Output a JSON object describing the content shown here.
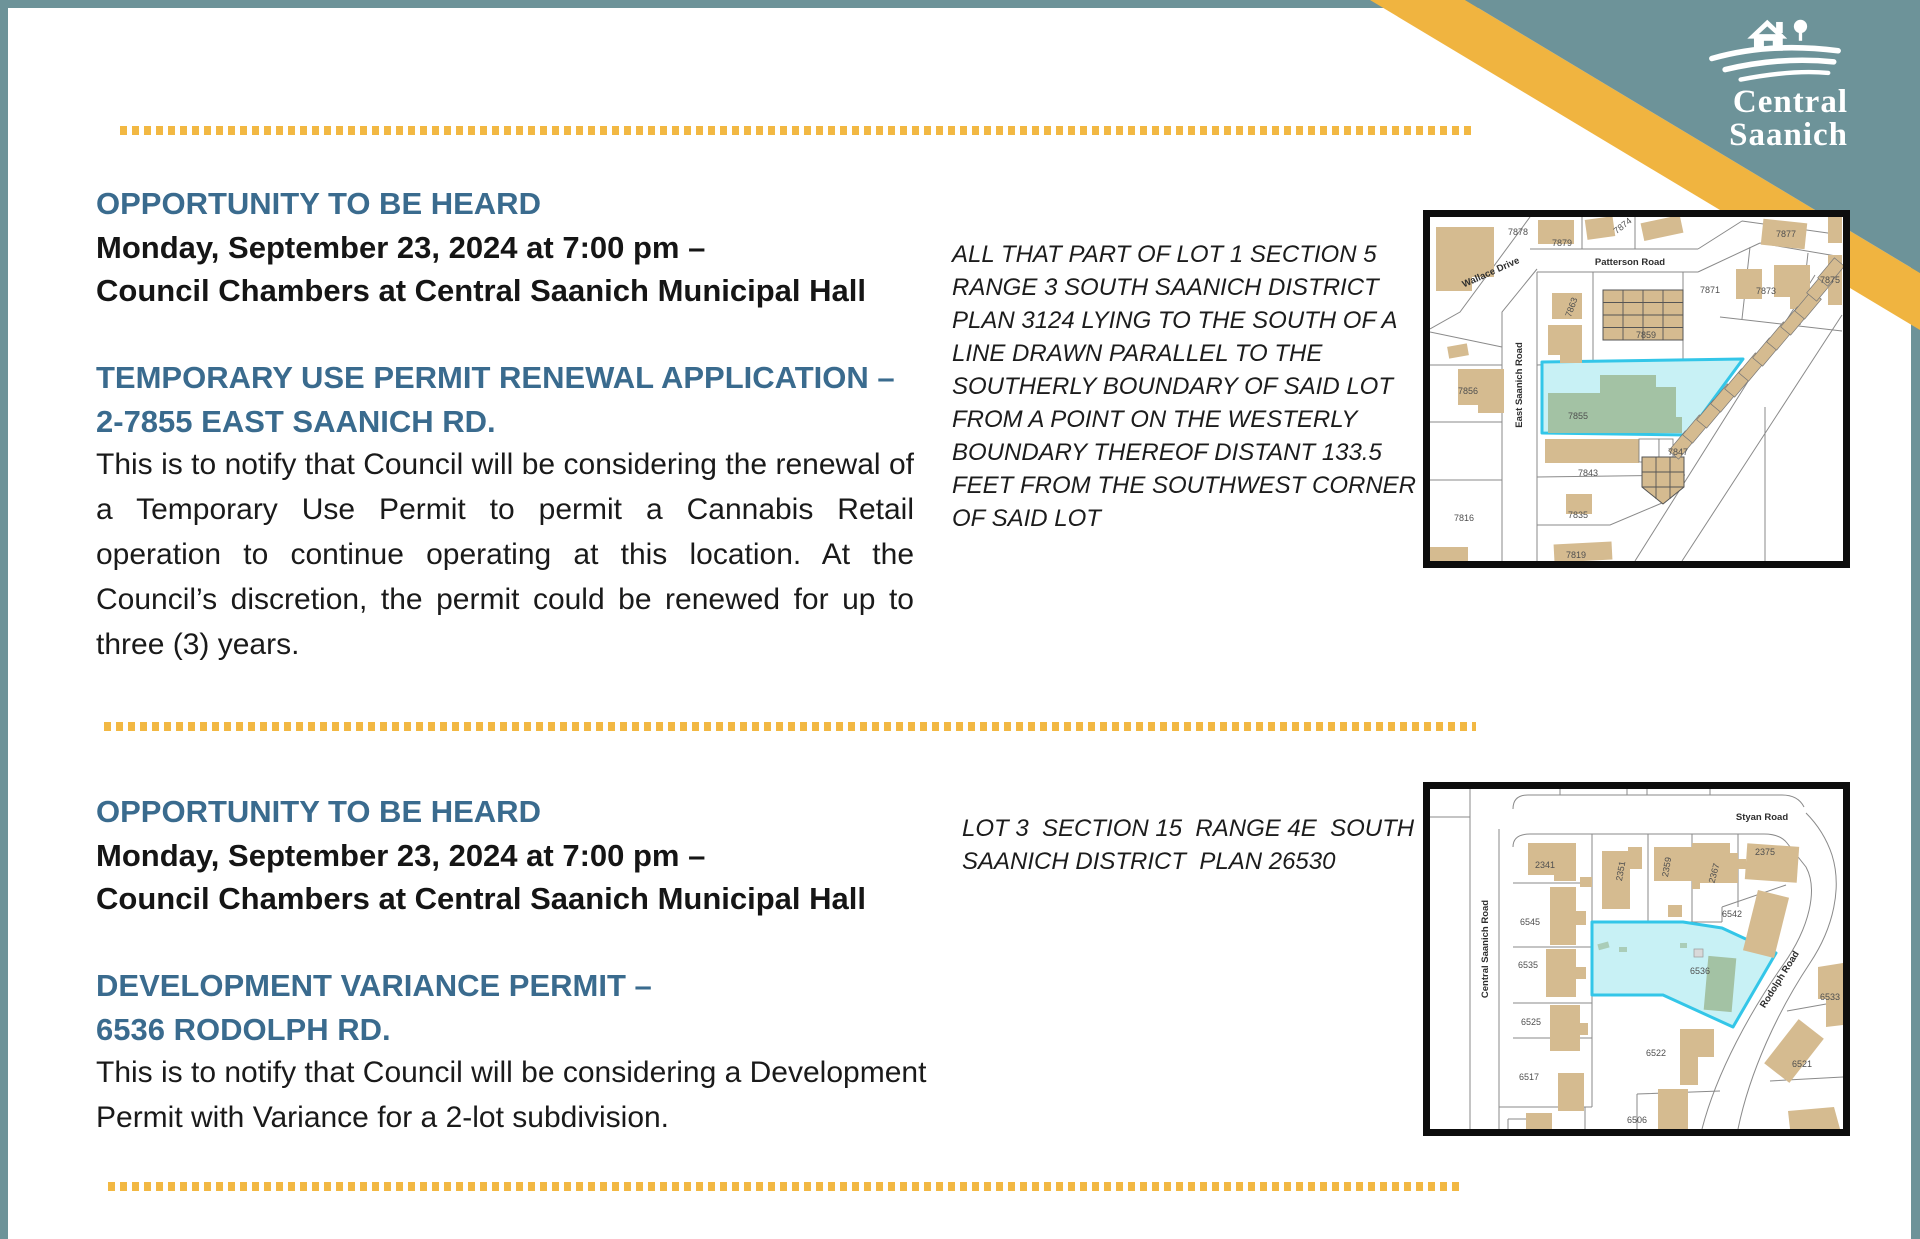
{
  "logo": {
    "line1": "Central",
    "line2": "Saanich"
  },
  "colors": {
    "teal": "#6d9399",
    "yellow": "#f2b843",
    "heading_blue": "#3a6b8e",
    "highlight_cyan": "#c8f1f5",
    "highlight_cyan_border": "#33c6e8",
    "building_tan": "#d5bb90",
    "building_green": "#a3c2a4"
  },
  "notices": [
    {
      "heading": "OPPORTUNITY TO BE HEARD",
      "date_line": "Monday, September 23, 2024 at 7:00 pm –",
      "location_line": "Council Chambers at Central Saanich Municipal Hall",
      "subject": "TEMPORARY USE PERMIT RENEWAL APPLICATION –\n2-7855 EAST SAANICH RD.",
      "body": "This is to notify that Council will be considering the renewal of a Temporary Use Permit to permit a Cannabis Retail operation to continue operating at this location. At the Council’s discretion, the permit could be renewed for up to three (3) years.",
      "legal_description": "ALL THAT PART OF LOT 1 SECTION 5\nRANGE 3 SOUTH SAANICH DISTRICT\nPLAN 3124 LYING TO THE SOUTH OF A\nLINE DRAWN PARALLEL TO THE\nSOUTHERLY BOUNDARY OF SAID LOT\nFROM A POINT ON THE WESTERLY\nBOUNDARY THEREOF DISTANT 133.5\nFEET FROM THE SOUTHWEST CORNER\nOF SAID LOT"
    },
    {
      "heading": "OPPORTUNITY TO BE HEARD",
      "date_line": "Monday, September 23, 2024 at 7:00 pm –",
      "location_line": "Council Chambers at Central Saanich Municipal Hall",
      "subject": "DEVELOPMENT VARIANCE PERMIT –\n6536 RODOLPH RD.",
      "body": "This is to notify that Council will be considering a Development Permit with Variance for a 2-lot subdivision.",
      "legal_description": "LOT 3  SECTION 15  RANGE 4E  SOUTH\nSAANICH DISTRICT  PLAN 26530"
    }
  ],
  "map1": {
    "roads": {
      "wallace": "Wallace Drive",
      "patterson": "Patterson Road",
      "east_saanich": "East Saanich Road"
    },
    "parcels": {
      "p7878": "7878",
      "p7879": "7879",
      "p7874": "7874",
      "p7877": "7877",
      "p7871": "7871",
      "p7873": "7873",
      "p7875": "7875",
      "p7863": "7863",
      "p7859": "7859",
      "p7856": "7856",
      "p7855": "7855",
      "p7843": "7843",
      "p7847": "7847",
      "p7835": "7835",
      "p7816": "7816",
      "p7819": "7819"
    },
    "highlighted_parcel": "7855"
  },
  "map2": {
    "roads": {
      "styan": "Styan Road",
      "central_saanich": "Central Saanich Road",
      "rodolph": "Rodolph Road"
    },
    "parcels": {
      "p2341": "2341",
      "p2351": "2351",
      "p2359": "2359",
      "p2367": "2367",
      "p2375": "2375",
      "p6545": "6545",
      "p6542": "6542",
      "p6535": "6535",
      "p6536": "6536",
      "p6533": "6533",
      "p6525": "6525",
      "p6522": "6522",
      "p6521": "6521",
      "p6517": "6517",
      "p6506": "6506"
    },
    "highlighted_parcel": "6536"
  }
}
